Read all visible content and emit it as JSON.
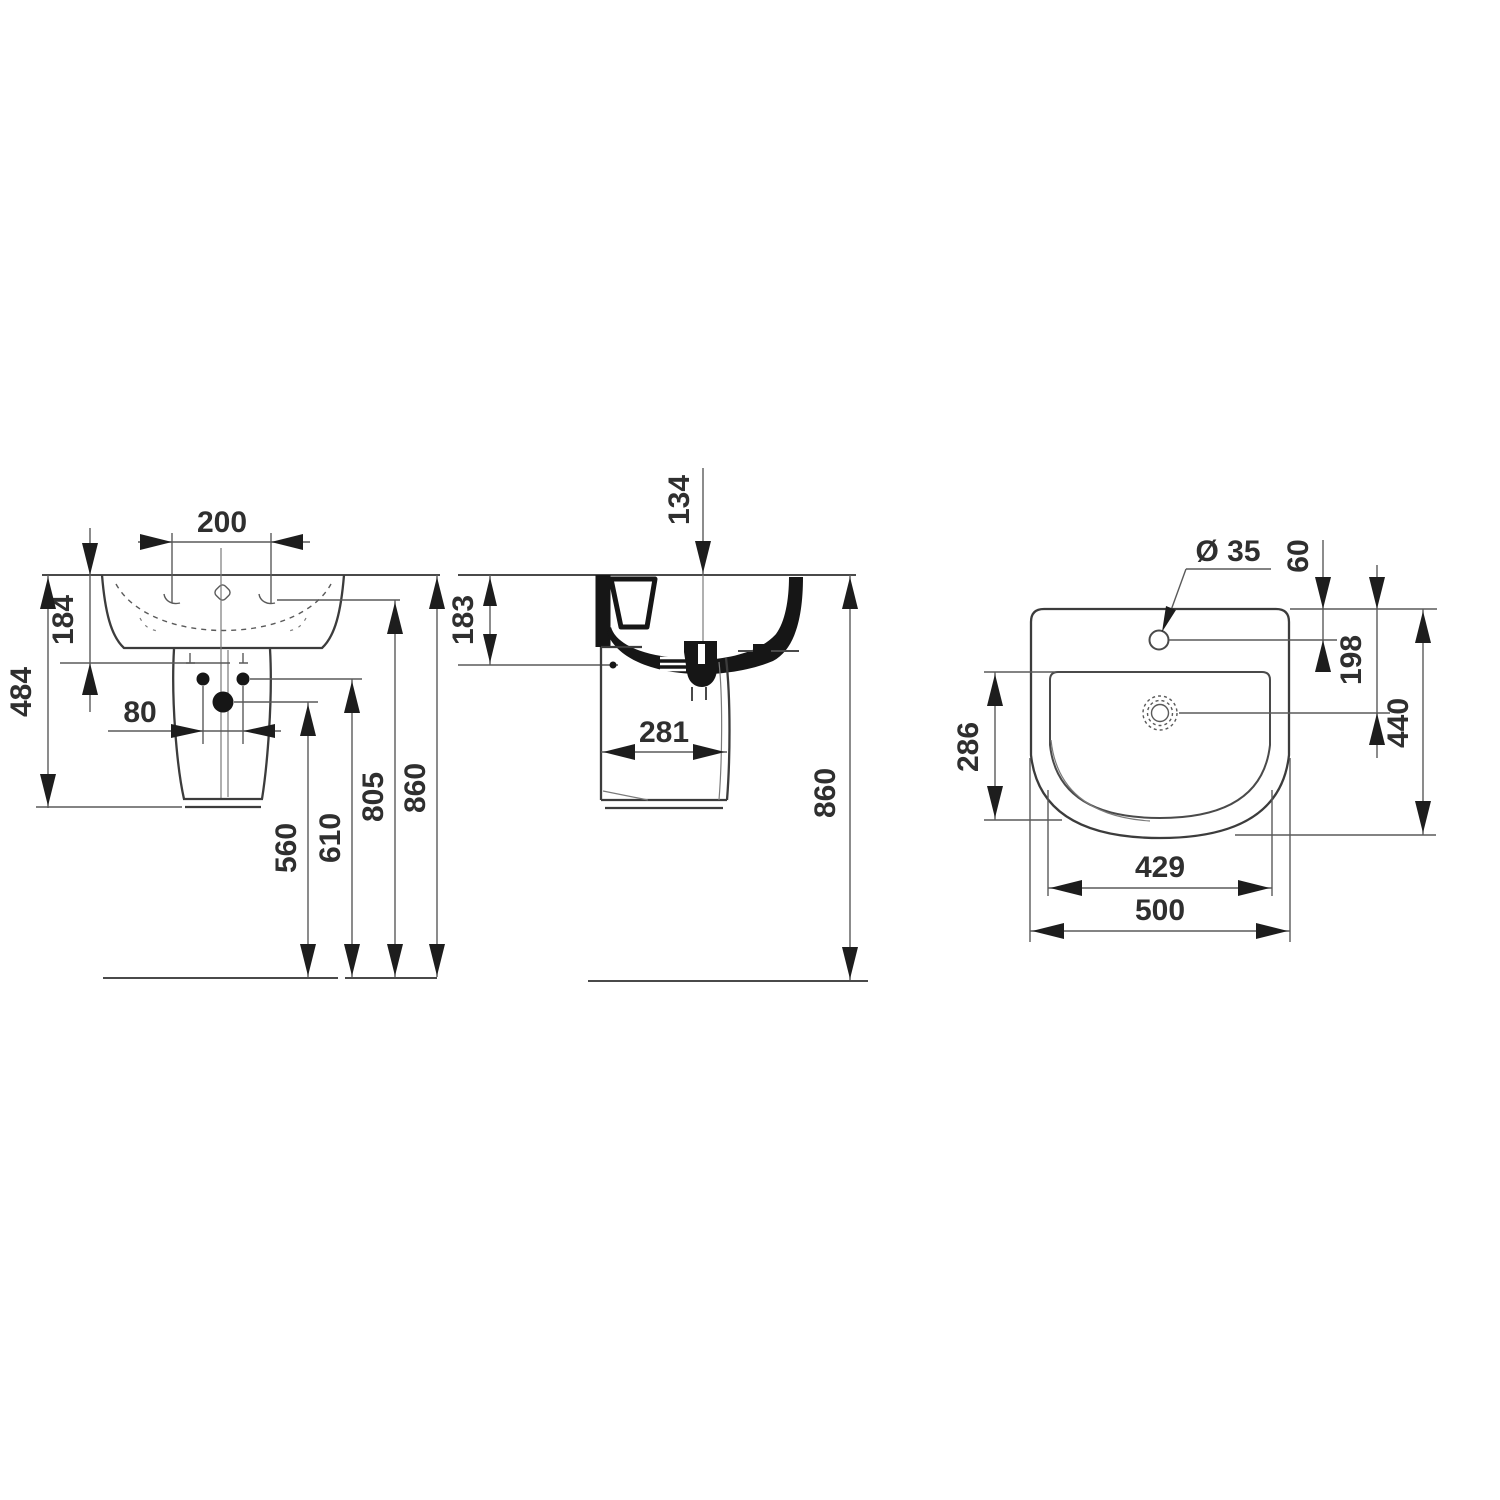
{
  "drawing_title": "Washbasin with semi pedestal - dimensional technical drawing",
  "front_view": {
    "labels": {
      "tap_hole_spacing": "200",
      "rim_to_fixing_line": "184",
      "rim_to_pedestal_base": "484",
      "fixing_hole_spacing": "80",
      "waste_outlet_height": "560",
      "fixing_holes_height": "610",
      "tap_hole_height": "805",
      "rim_height": "860"
    }
  },
  "side_view": {
    "labels": {
      "overflow_offset": "134",
      "rim_to_underside": "183",
      "pedestal_depth": "281",
      "rim_height": "860"
    }
  },
  "top_view": {
    "labels": {
      "tap_hole_diameter": "Ø 35",
      "rim_to_tap_center": "60",
      "rim_to_waste_center": "198",
      "bowl_depth": "286",
      "overall_depth": "440",
      "bowl_width": "429",
      "overall_width": "500"
    }
  },
  "colors": {
    "background": "#ffffff",
    "line": "#3c3c3c",
    "text": "#2f2f2f",
    "section_fill": "#161616"
  }
}
